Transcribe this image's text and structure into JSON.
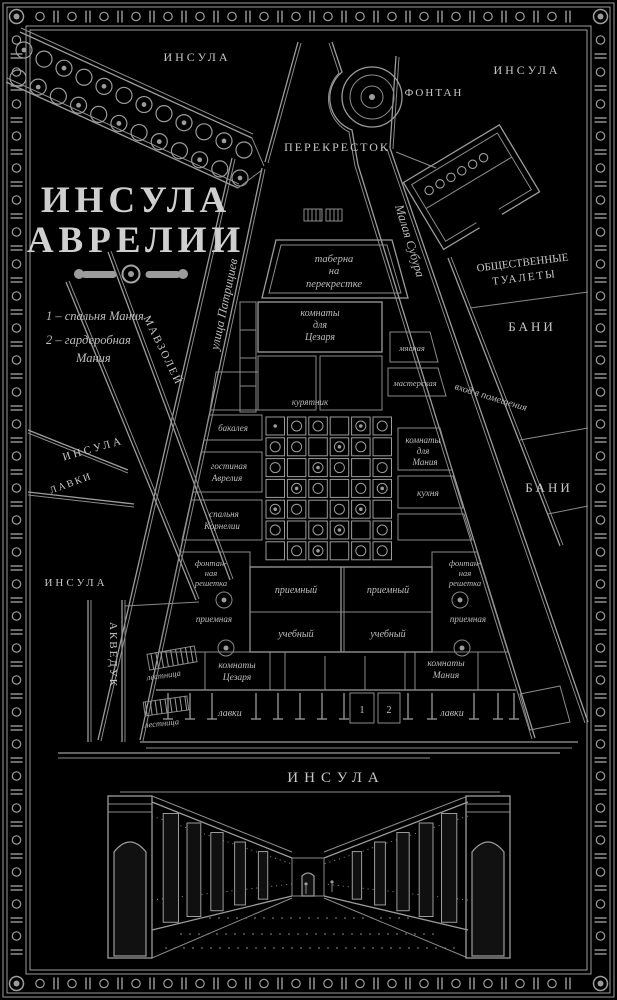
{
  "palette": {
    "bg": "#000000",
    "ink": "#9c9c9c",
    "text": "#bdbdbd"
  },
  "title": {
    "line1": "ИНСУЛА",
    "line2": "АВРЕЛИИ"
  },
  "legend": {
    "item1": "1 – спальня Мания",
    "item2a": "2 – гардеробная",
    "item2b": "Мания"
  },
  "areas": {
    "insula": "ИНСУЛА",
    "crossroad": "ПЕРЕКРЕСТОК",
    "fountain": "ФОНТАН",
    "toilets1": "ОБЩЕСТВЕННЫЕ",
    "toilets2": "ТУАЛЕТЫ",
    "baths": "БАНИ",
    "mausoleum": "МАВЗОЛЕЙ",
    "aqueduct": "АКВЕДУК",
    "shops": "ЛАВКИ"
  },
  "streets": {
    "patrician": "улица Патрициев",
    "subura": "Малая Субура"
  },
  "rooms": {
    "taberna1": "таберна",
    "taberna2": "на",
    "taberna3": "перекрестке",
    "caesar_top1": "комнаты",
    "caesar_top2": "для",
    "caesar_top3": "Цезаря",
    "entrance": "вход в помещения",
    "manius_mid1": "комнаты",
    "manius_mid2": "для",
    "manius_mid3": "Мания",
    "kitchen": "кухня",
    "butcher": "мясная",
    "workshop": "мастерская",
    "grocery": "бакалея",
    "henhouse": "курятник",
    "aurelius1": "гостиная",
    "aurelius2": "Аврелия",
    "cornelia1": "спальня",
    "cornelia2": "Корнелии",
    "reception_hall": "приемный",
    "school_hall": "учебный",
    "grate1": "фонтан-",
    "grate2": "ная",
    "grate3": "решетка",
    "anteroom": "приемная",
    "caesar_bot1": "комнаты",
    "caesar_bot2": "Цезаря",
    "manius_bot1": "комнаты",
    "manius_bot2": "Мания",
    "stalls": "лавки",
    "stairs": "лестница",
    "num1": "1",
    "num2": "2"
  },
  "bottom": {
    "insula": "ИНСУЛА"
  }
}
